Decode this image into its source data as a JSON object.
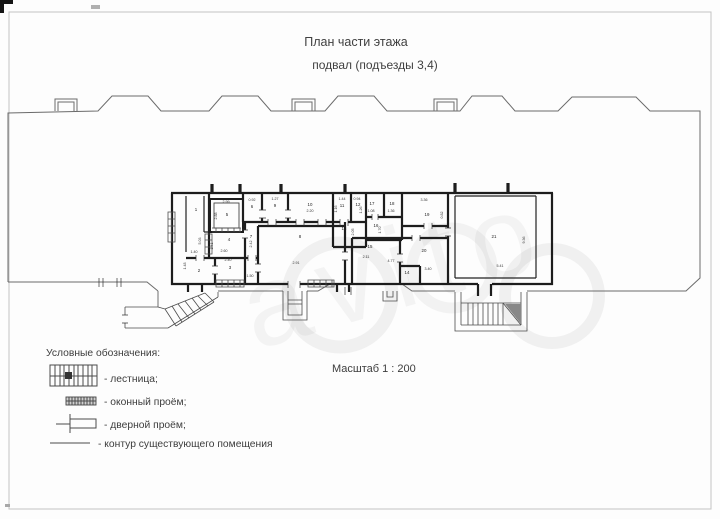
{
  "page": {
    "title": "План части этажа",
    "subtitle": "подвал (подъезды 3,4)",
    "scale_label": "Масштаб 1 : 200"
  },
  "legend": {
    "header": "Условные обозначения:",
    "items": [
      {
        "icon": "staircase-icon",
        "label": "- лестница;"
      },
      {
        "icon": "window-opening-icon",
        "label": "- оконный проём;"
      },
      {
        "icon": "door-opening-icon",
        "label": "- дверной проём;"
      },
      {
        "icon": "contour-icon",
        "label": "- контур существующего помещения"
      }
    ]
  },
  "plan": {
    "rooms": [
      {
        "n": "1"
      },
      {
        "n": "2"
      },
      {
        "n": "3"
      },
      {
        "n": "4"
      },
      {
        "n": "5"
      },
      {
        "n": "6"
      },
      {
        "n": "7"
      },
      {
        "n": "8"
      },
      {
        "n": "9"
      },
      {
        "n": "10"
      },
      {
        "n": "11"
      },
      {
        "n": "12"
      },
      {
        "n": "13"
      },
      {
        "n": "14"
      },
      {
        "n": "15"
      },
      {
        "n": "16"
      },
      {
        "n": "17"
      },
      {
        "n": "18"
      },
      {
        "n": "19"
      },
      {
        "n": "20"
      },
      {
        "n": "21"
      }
    ],
    "dims": [
      {
        "v": "5.03"
      },
      {
        "v": "2.99"
      },
      {
        "v": "2.88"
      },
      {
        "v": "0.92"
      },
      {
        "v": "1.27"
      },
      {
        "v": "2.20"
      },
      {
        "v": "1.16"
      },
      {
        "v": "1.44"
      },
      {
        "v": "0.94"
      },
      {
        "v": "1.08"
      },
      {
        "v": "1.36"
      },
      {
        "v": "3.36"
      },
      {
        "v": "0.82"
      },
      {
        "v": "1.70"
      },
      {
        "v": "2.05"
      },
      {
        "v": "2.60"
      },
      {
        "v": "1.41"
      },
      {
        "v": "2.42"
      },
      {
        "v": "1.40"
      },
      {
        "v": "1.48"
      },
      {
        "v": "2.40"
      },
      {
        "v": "1.50"
      },
      {
        "v": "2.91"
      },
      {
        "v": "2.11"
      },
      {
        "v": "4.77"
      },
      {
        "v": "3.40"
      },
      {
        "v": "5.41"
      },
      {
        "v": "9.36"
      },
      {
        "v": "1.26"
      }
    ]
  },
  "watermark": {
    "text": "avito"
  },
  "colors": {
    "wall": "#1d1d1d",
    "outline": "#6b6b6b",
    "text": "#3e3e3e"
  }
}
